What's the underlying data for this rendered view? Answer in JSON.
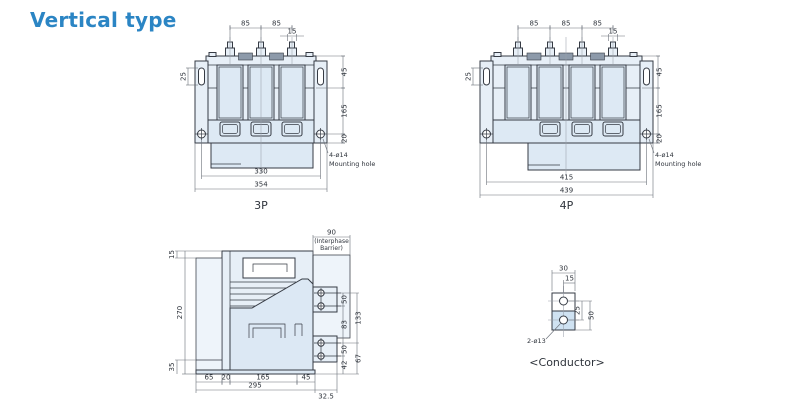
{
  "page": {
    "title": "Vertical type"
  },
  "colors": {
    "accent": "#2b85c4",
    "outline": "#363b44",
    "dim_line": "#6a7079",
    "fill_light": "#e7eff7",
    "fill_mid": "#dde9f4"
  },
  "views": {
    "front_3p": {
      "caption": "3P",
      "note1": "4-ø14",
      "note2": "Mounting hole",
      "dims": {
        "pitch1": "85",
        "pitch2": "85",
        "stud": "15",
        "slot": "25",
        "top": "45",
        "body": "165",
        "flange": "20",
        "holes": "330",
        "overall": "354"
      }
    },
    "front_4p": {
      "caption": "4P",
      "note1": "4-ø14",
      "note2": "Mounting hole",
      "dims": {
        "pitch1": "85",
        "pitch2": "85",
        "pitch3": "85",
        "stud": "15",
        "slot": "25",
        "top": "45",
        "body": "165",
        "flange": "20",
        "holes": "415",
        "overall": "439"
      }
    },
    "side": {
      "dims": {
        "barrier": "90",
        "barrier_note1": "(Interphase",
        "barrier_note2": "Barrier)",
        "top_step": "15",
        "height": "270",
        "bottom_step": "35",
        "b1": "65",
        "b2": "20",
        "b3": "165",
        "b4": "45",
        "total": "295",
        "ext": "32.5",
        "pitch_upper": "50",
        "gap": "83",
        "span": "133",
        "pitch_lower": "50",
        "offset": "42",
        "span2": "67"
      }
    },
    "conductor": {
      "caption": "<Conductor>",
      "note": "2-ø13",
      "dims": {
        "width": "30",
        "offset": "15",
        "pitch": "25",
        "height": "50"
      }
    }
  }
}
